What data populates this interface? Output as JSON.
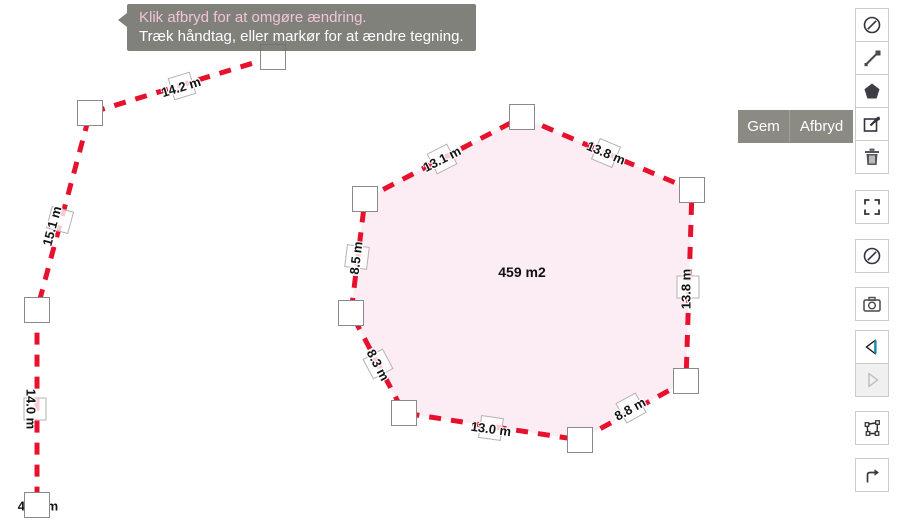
{
  "tooltip": {
    "line1": "Klik afbryd for at omgøre ændring.",
    "line2": "Træk håndtag, eller markør for at ændre tegning."
  },
  "actions": {
    "save_label": "Gem",
    "cancel_label": "Afbryd"
  },
  "polygon": {
    "area_label": "459 m2",
    "edges": [
      {
        "label": "13.1 m"
      },
      {
        "label": "13.8 m"
      },
      {
        "label": "13.8 m"
      },
      {
        "label": "8.8 m"
      },
      {
        "label": "13.0 m"
      },
      {
        "label": "8.3 m"
      },
      {
        "label": "8.5 m"
      }
    ]
  },
  "polyline": {
    "segments": [
      {
        "label": "14.2 m"
      },
      {
        "label": "15.1 m"
      },
      {
        "label": "14.0 m"
      }
    ],
    "total_label": "43.3 m"
  },
  "toolbar": {
    "items": [
      {
        "icon": "no-entry-icon"
      },
      {
        "icon": "measure-line-icon"
      },
      {
        "icon": "draw-polygon-icon"
      },
      {
        "icon": "edit-drawing-icon"
      },
      {
        "icon": "delete-icon"
      },
      {
        "icon": "fullscreen-icon"
      },
      {
        "icon": "no-entry-icon"
      },
      {
        "icon": "screenshot-icon"
      },
      {
        "icon": "previous-icon"
      },
      {
        "icon": "next-icon"
      },
      {
        "icon": "transform-polygon-icon"
      },
      {
        "icon": "export-icon"
      }
    ]
  },
  "colors": {
    "draw_red": "#e8112d",
    "polygon_fill": "#fbe7f0",
    "panel_grey": "#8b8b84",
    "tooltip_accent_text": "#f0c4d8"
  }
}
